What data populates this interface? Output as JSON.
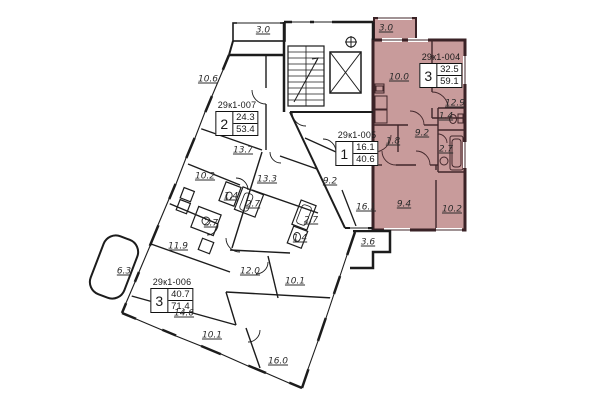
{
  "plan_name": "Residential floor plan",
  "colors": {
    "highlight": "#c89b9b",
    "wall": "#1c1c1c",
    "pink_wall": "#3a2226"
  },
  "apartments": [
    {
      "id": "29к1-007",
      "rooms": "2",
      "living_area": "24.3",
      "total_area": "53.4",
      "highlighted": false
    },
    {
      "id": "29к1-005",
      "rooms": "1",
      "living_area": "16.1",
      "total_area": "40.6",
      "highlighted": false
    },
    {
      "id": "29к1-004",
      "rooms": "3",
      "living_area": "32.5",
      "total_area": "59.1",
      "highlighted": true
    },
    {
      "id": "29к1-006",
      "rooms": "3",
      "living_area": "40.7",
      "total_area": "71.4",
      "highlighted": false
    }
  ],
  "room_labels": [
    {
      "t": "3.0",
      "x": 263,
      "y": 31
    },
    {
      "t": "3.0",
      "x": 386,
      "y": 29
    },
    {
      "t": "10.6",
      "x": 208,
      "y": 80
    },
    {
      "t": "13.7",
      "x": 243,
      "y": 151
    },
    {
      "t": "10.2",
      "x": 205,
      "y": 177
    },
    {
      "t": "13.3",
      "x": 267,
      "y": 180
    },
    {
      "t": "1.4",
      "x": 231,
      "y": 197
    },
    {
      "t": "2.7",
      "x": 253,
      "y": 205
    },
    {
      "t": "2.7",
      "x": 211,
      "y": 224
    },
    {
      "t": "11.9",
      "x": 178,
      "y": 247
    },
    {
      "t": "6.3",
      "x": 124,
      "y": 272
    },
    {
      "t": "12.0",
      "x": 250,
      "y": 272
    },
    {
      "t": "14.6",
      "x": 184,
      "y": 314
    },
    {
      "t": "10.1",
      "x": 212,
      "y": 336
    },
    {
      "t": "16.0",
      "x": 278,
      "y": 362
    },
    {
      "t": "10.1",
      "x": 295,
      "y": 282
    },
    {
      "t": "9.2",
      "x": 330,
      "y": 182
    },
    {
      "t": "16.1",
      "x": 366,
      "y": 208
    },
    {
      "t": "2.7",
      "x": 311,
      "y": 221
    },
    {
      "t": "1.4",
      "x": 300,
      "y": 239
    },
    {
      "t": "3.6",
      "x": 368,
      "y": 243
    },
    {
      "t": "10.0",
      "x": 399,
      "y": 78
    },
    {
      "t": "12.9",
      "x": 455,
      "y": 104
    },
    {
      "t": "1.4",
      "x": 446,
      "y": 117
    },
    {
      "t": "9.2",
      "x": 422,
      "y": 134
    },
    {
      "t": "1.8",
      "x": 393,
      "y": 142
    },
    {
      "t": "2.7",
      "x": 446,
      "y": 150
    },
    {
      "t": "9.4",
      "x": 404,
      "y": 205
    },
    {
      "t": "10.2",
      "x": 452,
      "y": 210
    }
  ]
}
